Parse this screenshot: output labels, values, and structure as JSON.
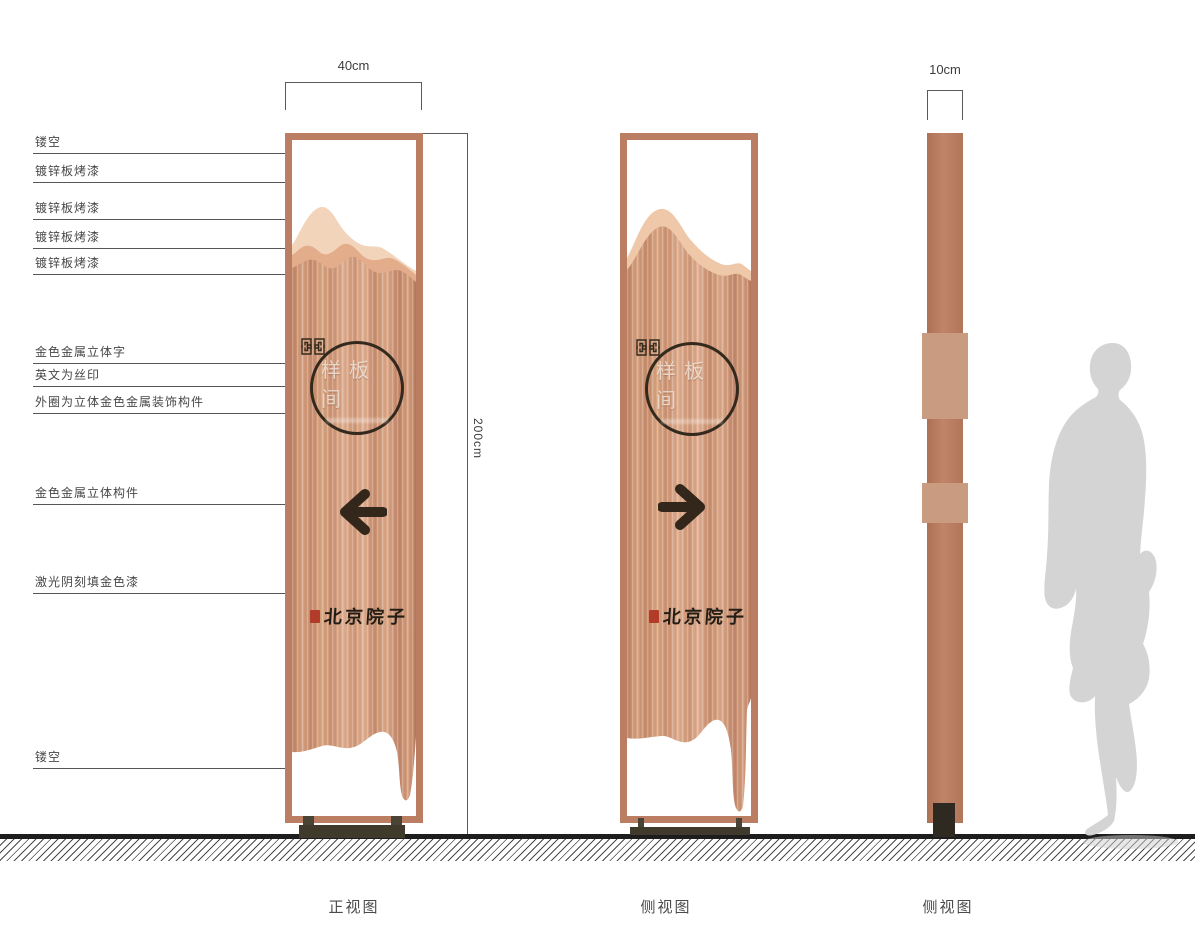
{
  "dims": {
    "front_width": "40cm",
    "total_height": "200cm",
    "depth": "10cm"
  },
  "annotations": [
    "镂空",
    "镀锌板烤漆",
    "镀锌板烤漆",
    "镀锌板烤漆",
    "镀锌板烤漆",
    "金色金属立体字",
    "英文为丝印",
    "外圈为立体金色金属装饰构件",
    "金色金属立体构件",
    "激光阴刻填金色漆",
    "镂空"
  ],
  "signage": {
    "room_name": "样板间",
    "brand_name": "北京院子"
  },
  "captions": [
    "正视图",
    "侧视图",
    "侧视图"
  ],
  "colors": {
    "frame_copper": "#bc7e62",
    "panel_copper": "#d09878",
    "mountain_light": "#f1d4ba",
    "mountain_mid": "#e3ac8b",
    "accent_dark": "#34291d",
    "seal_red": "#b23b2a",
    "base_olive": "#4a4436",
    "silhouette_gray": "#d4d4d4"
  }
}
